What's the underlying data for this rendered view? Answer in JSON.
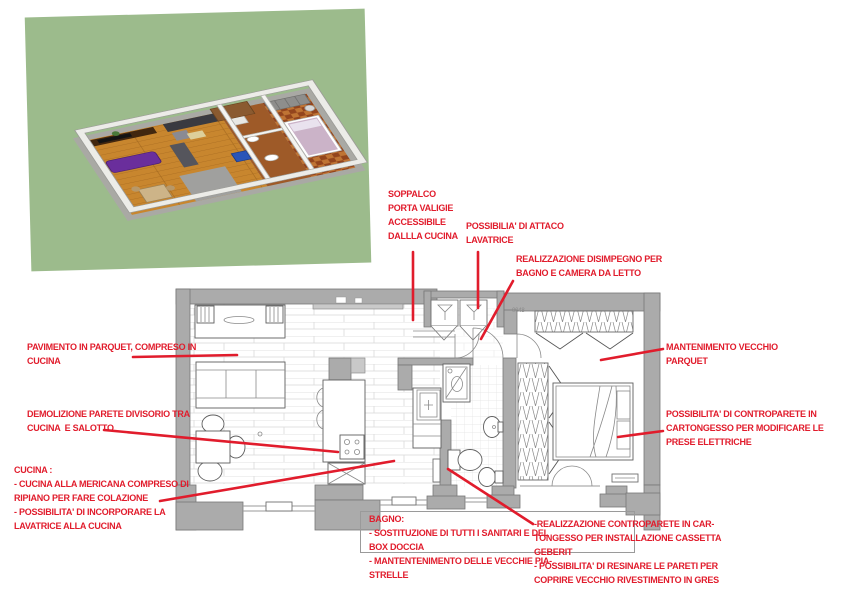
{
  "colors": {
    "annotation_red": "#e11c2c",
    "wall_gray": "#ababab",
    "render_green": "#9cbb8c",
    "parquet_line": "#d9d9d9",
    "wood_floor": "#c8862e",
    "bedroom_tile": "#93451d"
  },
  "plan": {
    "tiny_label": "0048"
  },
  "annotations": {
    "soppalco": {
      "text": "SOPPALCO\nPORTA VALIGIE\nACCESSIBILE\nDALLLA CUCINA"
    },
    "attacco_lavatrice": {
      "text": "POSSIBILIA' DI ATTACO\nLAVATRICE"
    },
    "disimpegno": {
      "text": "REALIZZAZIONE DISIMPEGNO PER\nBAGNO E CAMERA DA LETTO"
    },
    "pavimento": {
      "text": "PAVIMENTO IN PARQUET, COMPRESO IN\nCUCINA"
    },
    "demolizione": {
      "text": "DEMOLIZIONE PARETE DIVISORIO TRA\nCUCINA  E SALOTTO"
    },
    "cucina": {
      "text": "CUCINA :\n- CUCINA ALLA MERICANA COMPRESO DI\nRIPIANO PER FARE COLAZIONE\n- POSSIBILITA' DI INCORPORARE LA\nLAVATRICE ALLA CUCINA"
    },
    "mantenimento": {
      "text": "MANTENIMENTO VECCHIO\nPARQUET"
    },
    "controparete": {
      "text": "POSSIBILITA' DI CONTROPARETE IN\nCARTONGESSO PER MODIFICARE LE\nPRESE ELETTRICHE"
    },
    "bagno": {
      "text": "BAGNO:\n- SOSTITUZIONE DI TUTTI I SANITARI E DEL\nBOX DOCCIA\n- MANTENTENIMENTO DELLE VECCHIE PIA-\nSTRELLE"
    },
    "geberit": {
      "text": "-REALIZZAZIONE CONTROPARETE IN CAR-\nTONGESSO PER INSTALLAZIONE CASSETTA\nGEBERIT\n- POSSIBILITA' DI RESINARE LE PARETI PER\nCOPRIRE VECCHIO RIVESTIMENTO IN GRES"
    }
  }
}
